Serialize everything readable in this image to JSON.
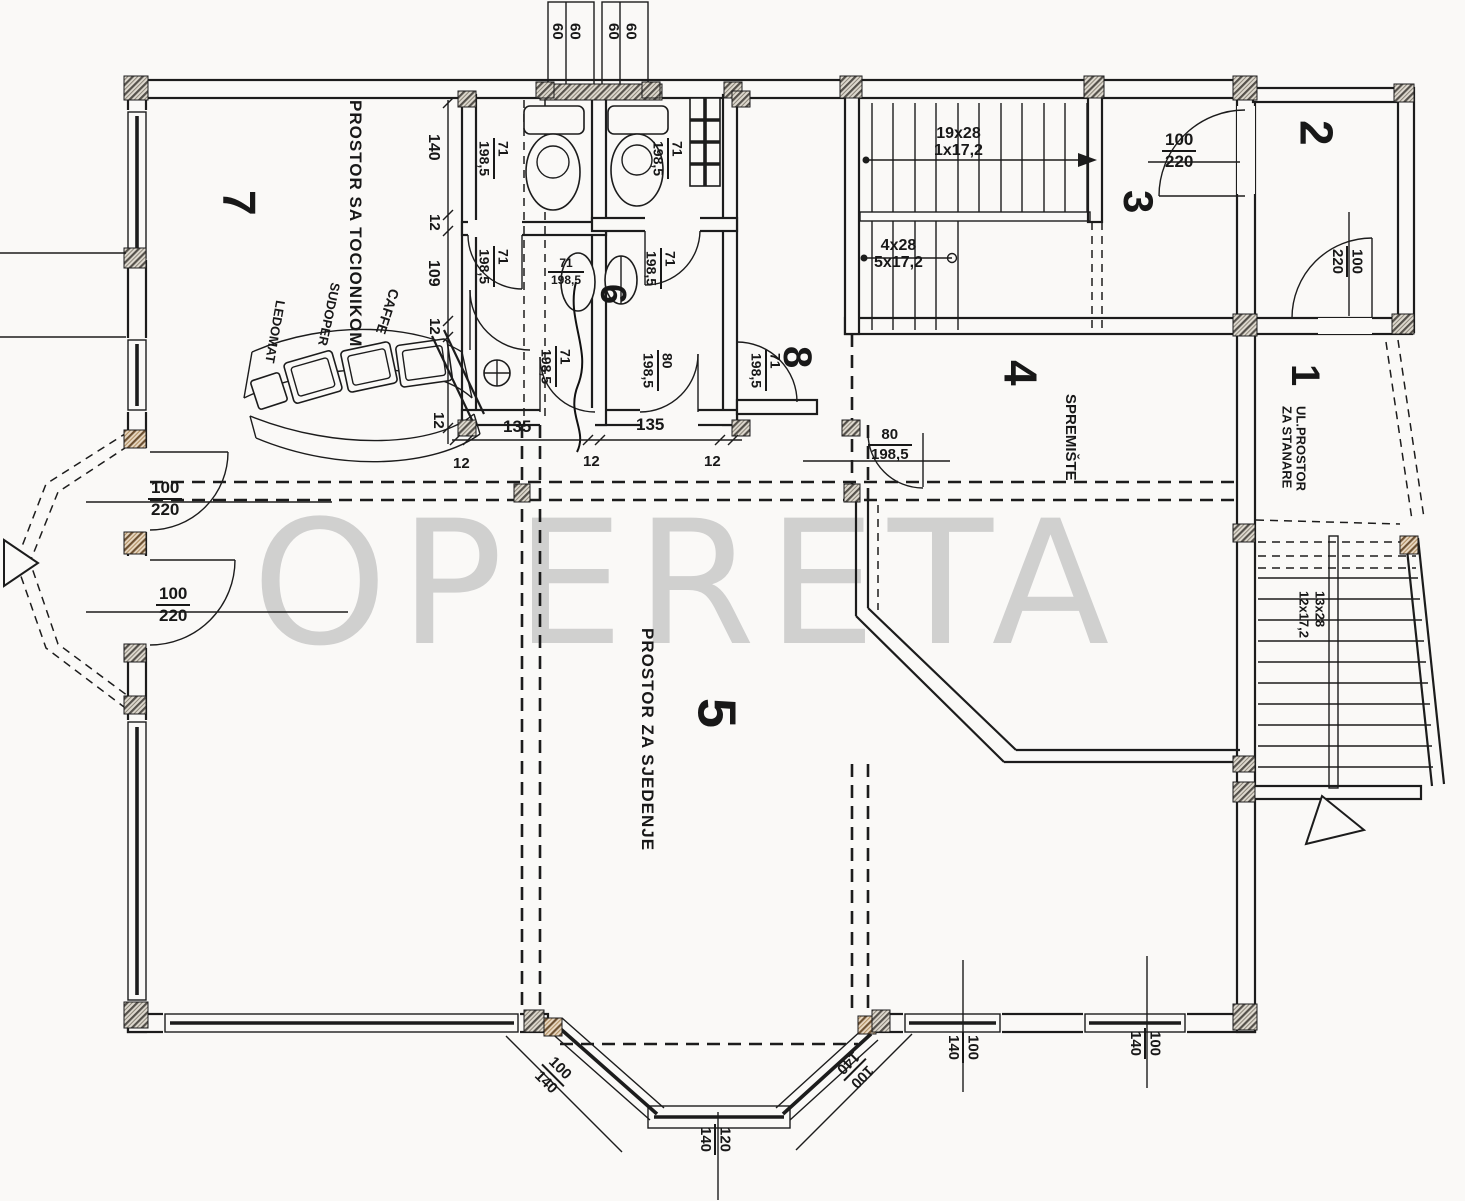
{
  "watermark": "OPERETA",
  "rooms": {
    "r1": {
      "num": "1",
      "line1": "UL.PROSTOR",
      "line2": "ZA STANARE"
    },
    "r2": {
      "num": "2"
    },
    "r3": {
      "num": "3"
    },
    "r4": {
      "num": "4",
      "label": "SPREMIŠTE"
    },
    "r5": {
      "num": "5",
      "label": "PROSTOR ZA SJEDENJE"
    },
    "r6": {
      "num": "6"
    },
    "r7": {
      "num": "7",
      "label": "PROSTOR SA TOCIONIKOM"
    },
    "r8": {
      "num": "8"
    }
  },
  "bar": {
    "caffe": "CAFFE",
    "sudoper": "SUDOPER",
    "ledomat": "LEDOMAT"
  },
  "stairs": {
    "main_upper": {
      "line1": "19x28",
      "line2": "1x17,2"
    },
    "main_lower": {
      "line1": "4x28",
      "line2": "5x17,2"
    },
    "entry": {
      "line1": "13x28",
      "line2": "12x17,2"
    }
  },
  "doors": {
    "d100_220": {
      "w": "100",
      "h": "220"
    },
    "d71_198": {
      "w": "71",
      "h": "198,5"
    },
    "d80_198": {
      "w": "80",
      "h": "198,5"
    }
  },
  "windows": {
    "w60": {
      "a": "60",
      "b": "60"
    },
    "w100_140": {
      "w": "100",
      "h": "140"
    },
    "w120_140": {
      "w": "120",
      "h": "140"
    }
  },
  "dims": {
    "d140": "140",
    "d12": "12",
    "d109": "109",
    "d135": "135"
  }
}
